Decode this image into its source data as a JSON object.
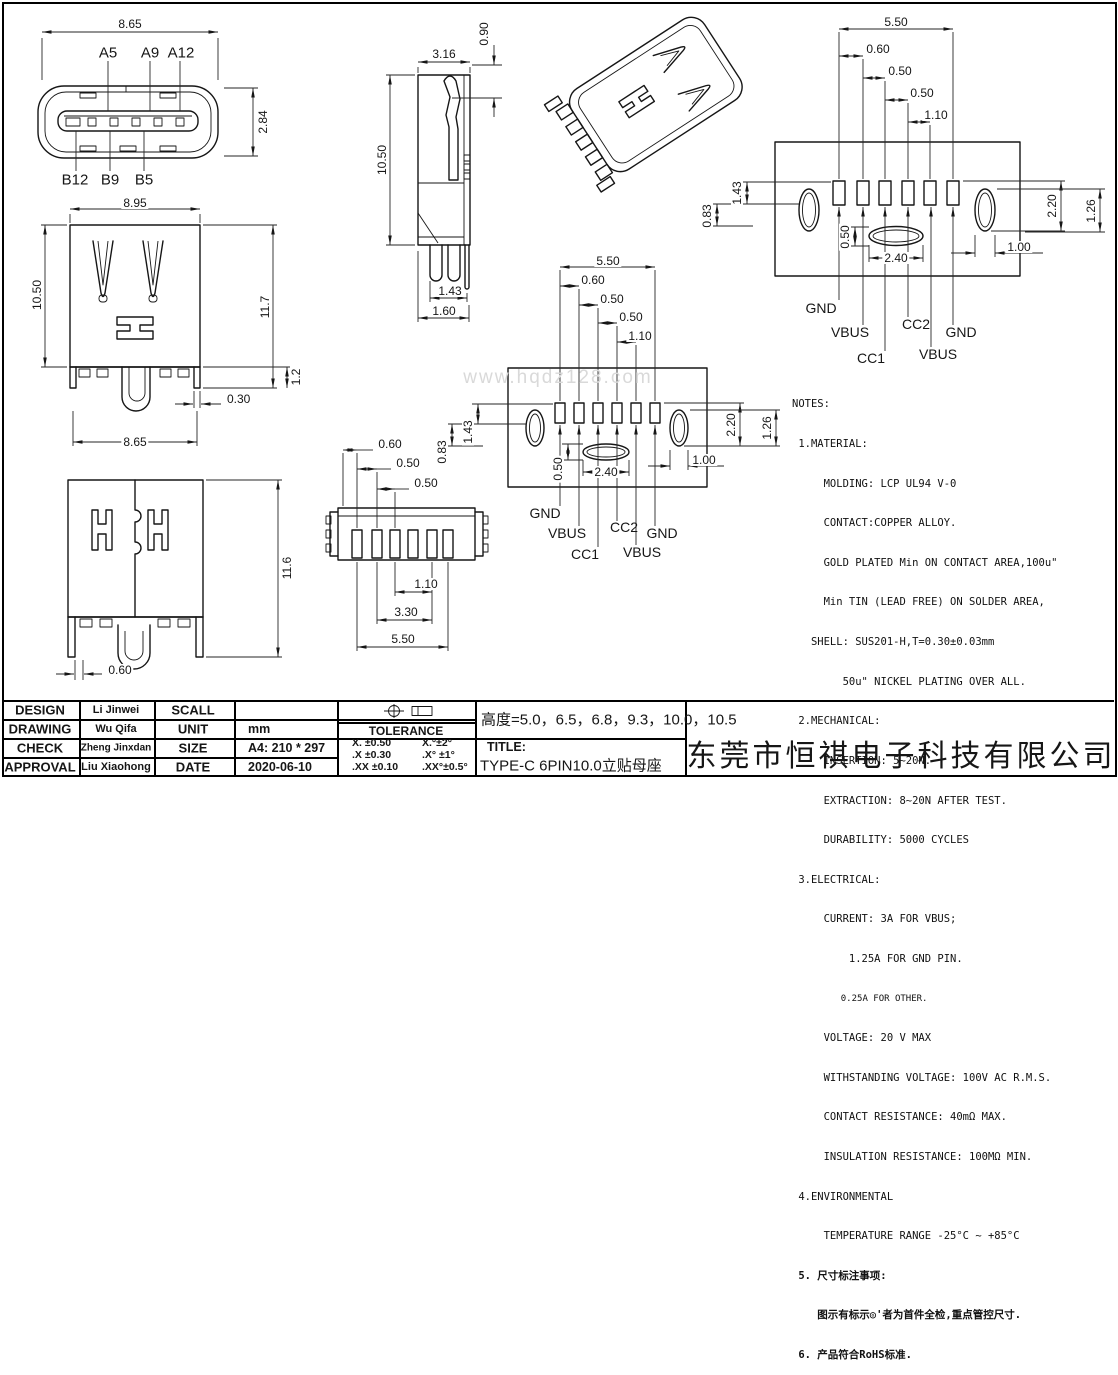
{
  "watermark": "www.hqdz128.com",
  "company": "东莞市恒祺电子科技有限公司",
  "height_note": "高度=5.0，6.5，6.8，9.3，10.0，10.5",
  "title_block": {
    "rows": [
      {
        "label": "DESIGN",
        "name": "Li Jinwei",
        "label2": "SCALL",
        "value": ""
      },
      {
        "label": "DRAWING",
        "name": "Wu Qifa",
        "label2": "UNIT",
        "value": "mm"
      },
      {
        "label": "CHECK",
        "name": "Zheng Jinxdan",
        "label2": "SIZE",
        "value": "A4: 210 * 297"
      },
      {
        "label": "APPROVAL",
        "name": "Liu Xiaohong",
        "label2": "DATE",
        "value": "2020-06-10"
      }
    ],
    "tolerance": {
      "title": "TOLERANCE",
      "rows": [
        {
          "left": "X.  ±0.50",
          "right": "X.°±2°"
        },
        {
          "left": ".X  ±0.30",
          "right": ".X° ±1°"
        },
        {
          "left": ".XX ±0.10",
          "right": ".XX°±0.5°"
        }
      ]
    },
    "title_label": "TITLE:",
    "title_value": "TYPE-C 6PIN10.0立贴母座"
  },
  "notes": {
    "lines": [
      "NOTES:",
      " 1.MATERIAL:",
      "     MOLDING: LCP UL94 V-0",
      "     CONTACT:COPPER ALLOY.",
      "     GOLD PLATED Min ON CONTACT AREA,100u\"",
      "     Min TIN (LEAD FREE) ON SOLDER AREA,",
      "   SHELL: SUS201-H,T=0.30±0.03mm",
      "        50u\" NICKEL PLATING OVER ALL.",
      " 2.MECHANICAL:",
      "     INSERTION: 5~20N.",
      "     EXTRACTION: 8~20N AFTER TEST.",
      "     DURABILITY: 5000 CYCLES",
      " 3.ELECTRICAL:",
      "     CURRENT: 3A FOR VBUS;",
      "         1.25A FOR GND PIN.",
      "         0.25A FOR OTHER.",
      "     VOLTAGE: 20 V MAX",
      "     WITHSTANDING VOLTAGE: 100V AC R.M.S.",
      "     CONTACT RESISTANCE: 40mΩ MAX.",
      "     INSULATION RESISTANCE: 100MΩ MIN.",
      " 4.ENVIRONMENTAL",
      "     TEMPERATURE RANGE -25°C ~ +85°C",
      " 5. 尺寸标注事项:",
      "    图示有标示◎'者为首件全检,重点管控尺寸.",
      " 6. 产品符合RoHS标准."
    ]
  },
  "views": {
    "front_face": {
      "dim_width": "8.65",
      "dim_height": "2.84",
      "pins_top": [
        "A5",
        "A9",
        "A12"
      ],
      "pins_bottom": [
        "B12",
        "B9",
        "B5"
      ]
    },
    "rear": {
      "dim_top": "8.95",
      "dim_left": "10.50",
      "dim_right": "11.7",
      "dim_leg": "1.2",
      "dim_offset": "0.30",
      "dim_bottom": "8.65"
    },
    "side": {
      "dim_depth": "3.16",
      "dim_offset": "0.90",
      "dim_height": "10.50",
      "dim_pin_a": "1.43",
      "dim_pin_b": "1.60"
    },
    "footprint": {
      "dim_span": "5.50",
      "dim_p1": "0.60",
      "dim_p2": "0.50",
      "dim_p3": "0.50",
      "dim_p4": "1.10",
      "dim_left_a": "0.83",
      "dim_left_b": "1.43",
      "dim_mid_a": "0.50",
      "dim_mid_b": "2.40",
      "dim_right_a": "2.20",
      "dim_right_b": "1.26",
      "dim_right_c": "1.00",
      "pads": [
        "GND",
        "VBUS",
        "CC1",
        "CC2",
        "VBUS",
        "GND"
      ]
    },
    "front2": {
      "dim_height": "11.6",
      "dim_pin": "0.60"
    },
    "bottom": {
      "dim_p1": "0.60",
      "dim_p2": "0.50",
      "dim_p3": "0.50",
      "dim_g1": "1.10",
      "dim_g2": "3.30",
      "dim_g3": "5.50"
    }
  }
}
